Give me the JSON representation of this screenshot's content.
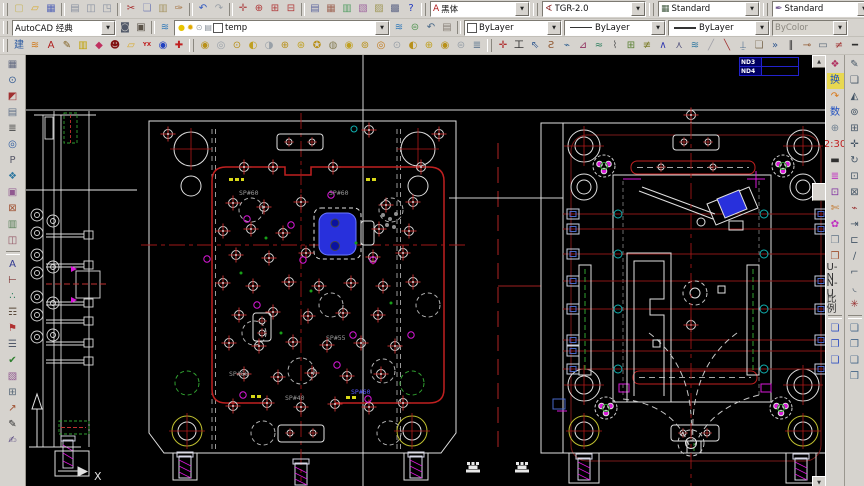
{
  "app": {
    "name": "AutoCAD",
    "workspace": "AutoCAD 经典"
  },
  "toolbars": {
    "standard": {
      "items": [
        {
          "name": "qnew-icon",
          "glyph": "▢",
          "color": "#c8b868"
        },
        {
          "name": "open-icon",
          "glyph": "▱",
          "color": "#d8a828"
        },
        {
          "name": "save-icon",
          "glyph": "▦",
          "color": "#5868b8"
        },
        {
          "sep": true
        },
        {
          "name": "plot-icon",
          "glyph": "▤",
          "color": "#8890a0"
        },
        {
          "name": "plot-preview-icon",
          "glyph": "◫",
          "color": "#8890a0"
        },
        {
          "name": "publish-icon",
          "glyph": "◳",
          "color": "#8890a0"
        },
        {
          "sep": true
        },
        {
          "name": "cut-icon",
          "glyph": "✂",
          "color": "#a83030"
        },
        {
          "name": "copy-icon",
          "glyph": "❏",
          "color": "#8088b8"
        },
        {
          "name": "paste-icon",
          "glyph": "▥",
          "color": "#a89868"
        },
        {
          "name": "match-properties-icon",
          "glyph": "✑",
          "color": "#a87848"
        },
        {
          "sep": true
        },
        {
          "name": "undo-icon",
          "glyph": "↶",
          "color": "#3058c0"
        },
        {
          "name": "redo-icon",
          "glyph": "↷",
          "color": "#9aa0a8"
        },
        {
          "sep": true
        },
        {
          "name": "pan-icon",
          "glyph": "✛",
          "color": "#b05050"
        },
        {
          "name": "zoom-realtime-icon",
          "glyph": "⊕",
          "color": "#b03838"
        },
        {
          "name": "zoom-window-icon",
          "glyph": "⊞",
          "color": "#b03838"
        },
        {
          "name": "zoom-previous-icon",
          "glyph": "⊟",
          "color": "#b03838"
        },
        {
          "sep": true
        },
        {
          "name": "properties-icon",
          "glyph": "▤",
          "color": "#6068a0"
        },
        {
          "name": "designcenter-icon",
          "glyph": "▦",
          "color": "#a06858"
        },
        {
          "name": "tool-palettes-icon",
          "glyph": "▥",
          "color": "#58a068"
        },
        {
          "name": "sheetset-manager-icon",
          "glyph": "▧",
          "color": "#a068a0"
        },
        {
          "name": "markup-set-manager-icon",
          "glyph": "▨",
          "color": "#a09858"
        },
        {
          "name": "quickcalc-icon",
          "glyph": "▩",
          "color": "#606888"
        },
        {
          "name": "help-icon",
          "glyph": "?",
          "color": "#2038c0"
        }
      ]
    },
    "styles": {
      "text_style": {
        "label": "黑体"
      },
      "dim_style": {
        "label": "TGR-2.0"
      },
      "table_style": {
        "label": "Standard"
      },
      "mleader_style": {
        "label": "Standard"
      }
    },
    "workspace_tools": {
      "items": [
        {
          "name": "workspace-settings-icon",
          "glyph": "◙",
          "color": "#505868"
        },
        {
          "name": "workspace-save-icon",
          "glyph": "▣",
          "color": "#5a5248"
        }
      ]
    },
    "layers": {
      "current": "temp",
      "indicators": [
        {
          "name": "layer-on-icon",
          "glyph": "●",
          "color": "#e8c400"
        },
        {
          "name": "layer-thaw-icon",
          "glyph": "✹",
          "color": "#e0a800"
        },
        {
          "name": "layer-lock-icon",
          "glyph": "⊙",
          "color": "#98a0a8"
        },
        {
          "name": "layer-plot-icon",
          "glyph": "▤",
          "color": "#88909a"
        }
      ],
      "tools": [
        {
          "name": "layer-properties-icon",
          "glyph": "≋",
          "color": "#3078b8"
        },
        {
          "name": "make-layer-current-icon",
          "glyph": "⊜",
          "color": "#589858"
        },
        {
          "name": "layer-previous-icon",
          "glyph": "↶",
          "color": "#486888"
        },
        {
          "name": "layer-states-icon",
          "glyph": "▤",
          "color": "#888078"
        }
      ]
    },
    "properties_panel": {
      "color": "ByLayer",
      "linetype": "ByLayer",
      "lineweight": "ByLayer",
      "plot_style": "ByColor"
    },
    "custom_left": {
      "items": [
        {
          "name": "tool-jian",
          "glyph": "建",
          "color": "#2858a0"
        },
        {
          "name": "tool-waves",
          "glyph": "≋",
          "color": "#d07818"
        },
        {
          "name": "tool-text",
          "glyph": "A",
          "color": "#b02020"
        },
        {
          "name": "tool-pencil",
          "glyph": "✎",
          "color": "#806020"
        },
        {
          "name": "tool-colorbars",
          "glyph": "▥",
          "color": "#c0a000"
        },
        {
          "name": "tool-diamond",
          "glyph": "◆",
          "color": "#c03060"
        },
        {
          "name": "tool-face",
          "glyph": "☻",
          "color": "#801010"
        },
        {
          "name": "tool-folder",
          "glyph": "▱",
          "color": "#d8a828"
        },
        {
          "name": "tool-yx",
          "label": "YX",
          "color": "#c02020",
          "small": true
        },
        {
          "name": "tool-about",
          "glyph": "◉",
          "color": "#2040c0"
        },
        {
          "name": "tool-help2",
          "glyph": "✚",
          "color": "#c02020"
        }
      ]
    },
    "custom_mid": {
      "items": [
        {
          "name": "round-tool-1",
          "glyph": "◉",
          "color": "#b89018"
        },
        {
          "name": "round-tool-2",
          "glyph": "◎",
          "color": "#98a0a8"
        },
        {
          "name": "round-tool-3",
          "glyph": "⊙",
          "color": "#b89018"
        },
        {
          "name": "round-tool-4",
          "glyph": "◐",
          "color": "#c0a020"
        },
        {
          "name": "round-tool-5",
          "glyph": "◑",
          "color": "#98a0a8"
        },
        {
          "name": "round-tool-6",
          "glyph": "⊕",
          "color": "#b89018"
        },
        {
          "name": "round-tool-7",
          "glyph": "⊛",
          "color": "#c0a020"
        },
        {
          "name": "round-tool-8",
          "glyph": "✪",
          "color": "#b89018"
        },
        {
          "name": "round-tool-9",
          "glyph": "◍",
          "color": "#888058"
        },
        {
          "name": "round-tool-10",
          "glyph": "◉",
          "color": "#c0a020"
        },
        {
          "name": "round-tool-11",
          "glyph": "⊚",
          "color": "#b89018"
        },
        {
          "name": "round-tool-12",
          "glyph": "◎",
          "color": "#c07818"
        },
        {
          "name": "round-tool-13",
          "glyph": "⊙",
          "color": "#98a0a8"
        },
        {
          "name": "round-tool-14",
          "glyph": "◐",
          "color": "#b89018"
        },
        {
          "name": "round-tool-15",
          "glyph": "⊕",
          "color": "#c0a020"
        },
        {
          "name": "round-tool-16",
          "glyph": "◉",
          "color": "#b89018"
        },
        {
          "name": "round-tool-17",
          "glyph": "⊜",
          "color": "#98a0a8"
        },
        {
          "name": "round-tool-18",
          "glyph": "≣",
          "color": "#607890"
        }
      ]
    },
    "custom_lines": {
      "items": [
        {
          "name": "line-tool-1",
          "glyph": "✛",
          "color": "#b03030"
        },
        {
          "name": "line-tool-2",
          "glyph": "工",
          "color": "#303030"
        },
        {
          "name": "line-tool-3",
          "glyph": "⇖",
          "color": "#305890"
        },
        {
          "name": "line-tool-4",
          "glyph": "Ƨ",
          "color": "#905830"
        },
        {
          "name": "line-tool-5",
          "glyph": "⌁",
          "color": "#306090"
        },
        {
          "name": "line-tool-6",
          "glyph": "⊿",
          "color": "#903060"
        },
        {
          "name": "line-tool-7",
          "glyph": "≈",
          "color": "#308060"
        },
        {
          "name": "line-tool-8",
          "glyph": "⌇",
          "color": "#606060"
        },
        {
          "name": "line-tool-9",
          "glyph": "⊞",
          "color": "#588030"
        },
        {
          "name": "line-tool-10",
          "glyph": "≢",
          "color": "#808030"
        },
        {
          "name": "line-tool-11",
          "glyph": "∧",
          "color": "#3038b0"
        },
        {
          "name": "line-tool-12",
          "glyph": "⋏",
          "color": "#585880"
        },
        {
          "name": "line-tool-13",
          "glyph": "≋",
          "color": "#3078a0"
        },
        {
          "name": "line-tool-14",
          "glyph": "╱",
          "color": "#a0a0a8"
        },
        {
          "name": "line-tool-15",
          "glyph": "╲",
          "color": "#a03030"
        },
        {
          "name": "line-tool-16",
          "glyph": "⍊",
          "color": "#507090"
        },
        {
          "name": "line-tool-17",
          "glyph": "❏",
          "color": "#807058"
        },
        {
          "name": "line-tool-18",
          "glyph": "»",
          "color": "#305890"
        },
        {
          "name": "line-tool-19",
          "glyph": "∥",
          "color": "#303030"
        },
        {
          "name": "line-tool-20",
          "glyph": "⊸",
          "color": "#905830"
        },
        {
          "name": "line-tool-21",
          "glyph": "▭",
          "color": "#586878"
        },
        {
          "name": "line-tool-22",
          "glyph": "≠",
          "color": "#a03030"
        },
        {
          "name": "line-tool-23",
          "glyph": "━",
          "color": "#303030"
        },
        {
          "name": "line-tool-24",
          "glyph": "╪",
          "color": "#586878"
        }
      ]
    },
    "custom_win": {
      "items": [
        {
          "name": "win-tool-1",
          "glyph": "▭",
          "color": "#887860"
        },
        {
          "name": "win-tool-2",
          "glyph": "▭",
          "color": "#b03030"
        },
        {
          "name": "win-tool-3",
          "glyph": "╲",
          "color": "#505868"
        },
        {
          "name": "win-tool-4",
          "glyph": "╲",
          "color": "#b03030"
        },
        {
          "name": "win-tool-5",
          "glyph": "⊞",
          "color": "#788090"
        },
        {
          "name": "win-tool-6",
          "glyph": "◷",
          "color": "#303840"
        },
        {
          "name": "win-tool-7",
          "glyph": "⊘",
          "color": "#b03030"
        },
        {
          "name": "win-tool-8",
          "glyph": "◺",
          "color": "#788090"
        }
      ]
    },
    "left_bar": {
      "items": [
        {
          "name": "lt-grid",
          "glyph": "▦",
          "color": "#606880"
        },
        {
          "name": "lt-zoom",
          "glyph": "⊙",
          "color": "#305890"
        },
        {
          "name": "lt-red-block",
          "glyph": "◩",
          "color": "#a03030"
        },
        {
          "name": "lt-cells",
          "glyph": "▤",
          "color": "#607088"
        },
        {
          "name": "lt-list",
          "glyph": "≣",
          "color": "#484848"
        },
        {
          "name": "lt-ring",
          "glyph": "◎",
          "color": "#2858a0"
        },
        {
          "name": "lt-p",
          "glyph": "P",
          "color": "#585868"
        },
        {
          "name": "lt-layers",
          "glyph": "❖",
          "color": "#3078a0"
        },
        {
          "name": "lt-boxgrid",
          "glyph": "▣",
          "color": "#905890"
        },
        {
          "name": "lt-xbox",
          "glyph": "⊠",
          "color": "#a05030"
        },
        {
          "name": "lt-bars",
          "glyph": "▥",
          "color": "#588058"
        },
        {
          "name": "lt-split",
          "glyph": "◫",
          "color": "#905060"
        },
        {
          "sep": true
        },
        {
          "name": "lt-text",
          "glyph": "A",
          "color": "#303890"
        },
        {
          "name": "lt-dim",
          "glyph": "⊢",
          "color": "#803030"
        },
        {
          "name": "lt-dots",
          "glyph": "∴",
          "color": "#308060"
        },
        {
          "name": "lt-trigram",
          "glyph": "☶",
          "color": "#584838"
        },
        {
          "name": "lt-flag",
          "glyph": "⚑",
          "color": "#b03030"
        },
        {
          "name": "lt-lines",
          "glyph": "☰",
          "color": "#505868"
        },
        {
          "name": "lt-check",
          "glyph": "✔",
          "color": "#308030"
        },
        {
          "name": "lt-hatch",
          "glyph": "▧",
          "color": "#905890"
        },
        {
          "name": "lt-plus",
          "glyph": "⊞",
          "color": "#586878"
        },
        {
          "name": "lt-arrow",
          "glyph": "↗",
          "color": "#a05030"
        },
        {
          "name": "lt-pen",
          "glyph": "✎",
          "color": "#303030"
        },
        {
          "name": "lt-sign",
          "glyph": "✍",
          "color": "#584880"
        }
      ]
    },
    "right_inner": {
      "items": [
        {
          "name": "rt-mark",
          "glyph": "❖",
          "color": "#b03060"
        },
        {
          "name": "rt-swap",
          "label": "换",
          "color": "#2050c0",
          "bg": "#e8d850"
        },
        {
          "name": "rt-curve-arrow",
          "glyph": "↷",
          "color": "#d87818"
        },
        {
          "name": "rt-count",
          "label": "数",
          "color": "#2050c0"
        },
        {
          "name": "rt-target",
          "glyph": "⊕",
          "color": "#708090"
        },
        {
          "name": "rt-scale-230",
          "label": "2:30",
          "color": "#c02020",
          "small": true
        },
        {
          "name": "rt-blackbar",
          "glyph": "▬",
          "color": "#303030"
        },
        {
          "name": "rt-colorlines",
          "glyph": "≣",
          "color": "#c030c0"
        },
        {
          "name": "rt-boxdot",
          "glyph": "⊡",
          "color": "#8030a0"
        },
        {
          "name": "rt-snip",
          "glyph": "✄",
          "color": "#c07020"
        },
        {
          "name": "rt-flower",
          "glyph": "✿",
          "color": "#c030c0"
        },
        {
          "name": "rt-copyshape",
          "glyph": "❒",
          "color": "#708090"
        },
        {
          "name": "rt-copyshape2",
          "glyph": "❒",
          "color": "#a05030"
        },
        {
          "name": "rt-u-n",
          "label": "U-N",
          "color": "#303030",
          "small": true
        },
        {
          "name": "rt-n-u",
          "label": "N-U",
          "color": "#303030",
          "small": true
        },
        {
          "name": "rt-scale-cn",
          "label": "比例",
          "color": "#303030",
          "small": true
        },
        {
          "sep": true
        },
        {
          "name": "rt-stack-1",
          "glyph": "❏",
          "color": "#3050c0"
        },
        {
          "name": "rt-stack-2",
          "glyph": "❐",
          "color": "#3050c0"
        },
        {
          "name": "rt-stack-3",
          "glyph": "❑",
          "color": "#3050c0"
        }
      ]
    },
    "modify": {
      "items": [
        {
          "name": "erase-icon",
          "glyph": "✎",
          "color": "#445566"
        },
        {
          "name": "copy-object-icon",
          "glyph": "❏",
          "color": "#445566"
        },
        {
          "name": "mirror-icon",
          "glyph": "◭",
          "color": "#445566"
        },
        {
          "name": "offset-icon",
          "glyph": "⊚",
          "color": "#445566"
        },
        {
          "name": "array-icon",
          "glyph": "⊞",
          "color": "#445566"
        },
        {
          "name": "move-icon",
          "glyph": "✛",
          "color": "#445566"
        },
        {
          "name": "rotate-icon",
          "glyph": "↻",
          "color": "#445566"
        },
        {
          "name": "scale-icon",
          "glyph": "⊡",
          "color": "#445566"
        },
        {
          "name": "stretch-icon",
          "glyph": "⊠",
          "color": "#445566"
        },
        {
          "name": "trim-icon",
          "glyph": "⌁",
          "color": "#993333"
        },
        {
          "name": "extend-icon",
          "glyph": "⇥",
          "color": "#445566"
        },
        {
          "name": "break-icon",
          "glyph": "⊏",
          "color": "#445566"
        },
        {
          "name": "chamfer-icon",
          "glyph": "∕",
          "color": "#445566"
        },
        {
          "name": "fillet-icon",
          "glyph": "⌐",
          "color": "#445566"
        },
        {
          "name": "fillet2-icon",
          "glyph": "◟",
          "color": "#445566"
        },
        {
          "name": "explode-icon",
          "glyph": "✳",
          "color": "#993333"
        },
        {
          "sep": true
        },
        {
          "name": "draworder-front-icon",
          "glyph": "❏",
          "color": "#446688"
        },
        {
          "name": "draworder-back-icon",
          "glyph": "❐",
          "color": "#446688"
        },
        {
          "name": "draworder-above-icon",
          "glyph": "❑",
          "color": "#446688"
        },
        {
          "name": "draworder-under-icon",
          "glyph": "❒",
          "color": "#446688"
        }
      ]
    }
  },
  "canvas": {
    "labels": {
      "nd3": "ND3",
      "nd4": "ND4",
      "x_axis": "X",
      "sp60": "SP#60",
      "sp55": "SP#55",
      "sp40": "SP#40"
    },
    "colors": {
      "bg": "#000000",
      "line_white": "#e0e0e0",
      "line_red": "#c02020",
      "dark_red": "#8a1616",
      "magenta": "#d818d8",
      "cyan": "#10b0b0",
      "green": "#30a030",
      "yellow": "#d8d818",
      "blue_fill": "#2830dc",
      "gray_text": "#989898",
      "table_blue": "#2222cc"
    }
  }
}
